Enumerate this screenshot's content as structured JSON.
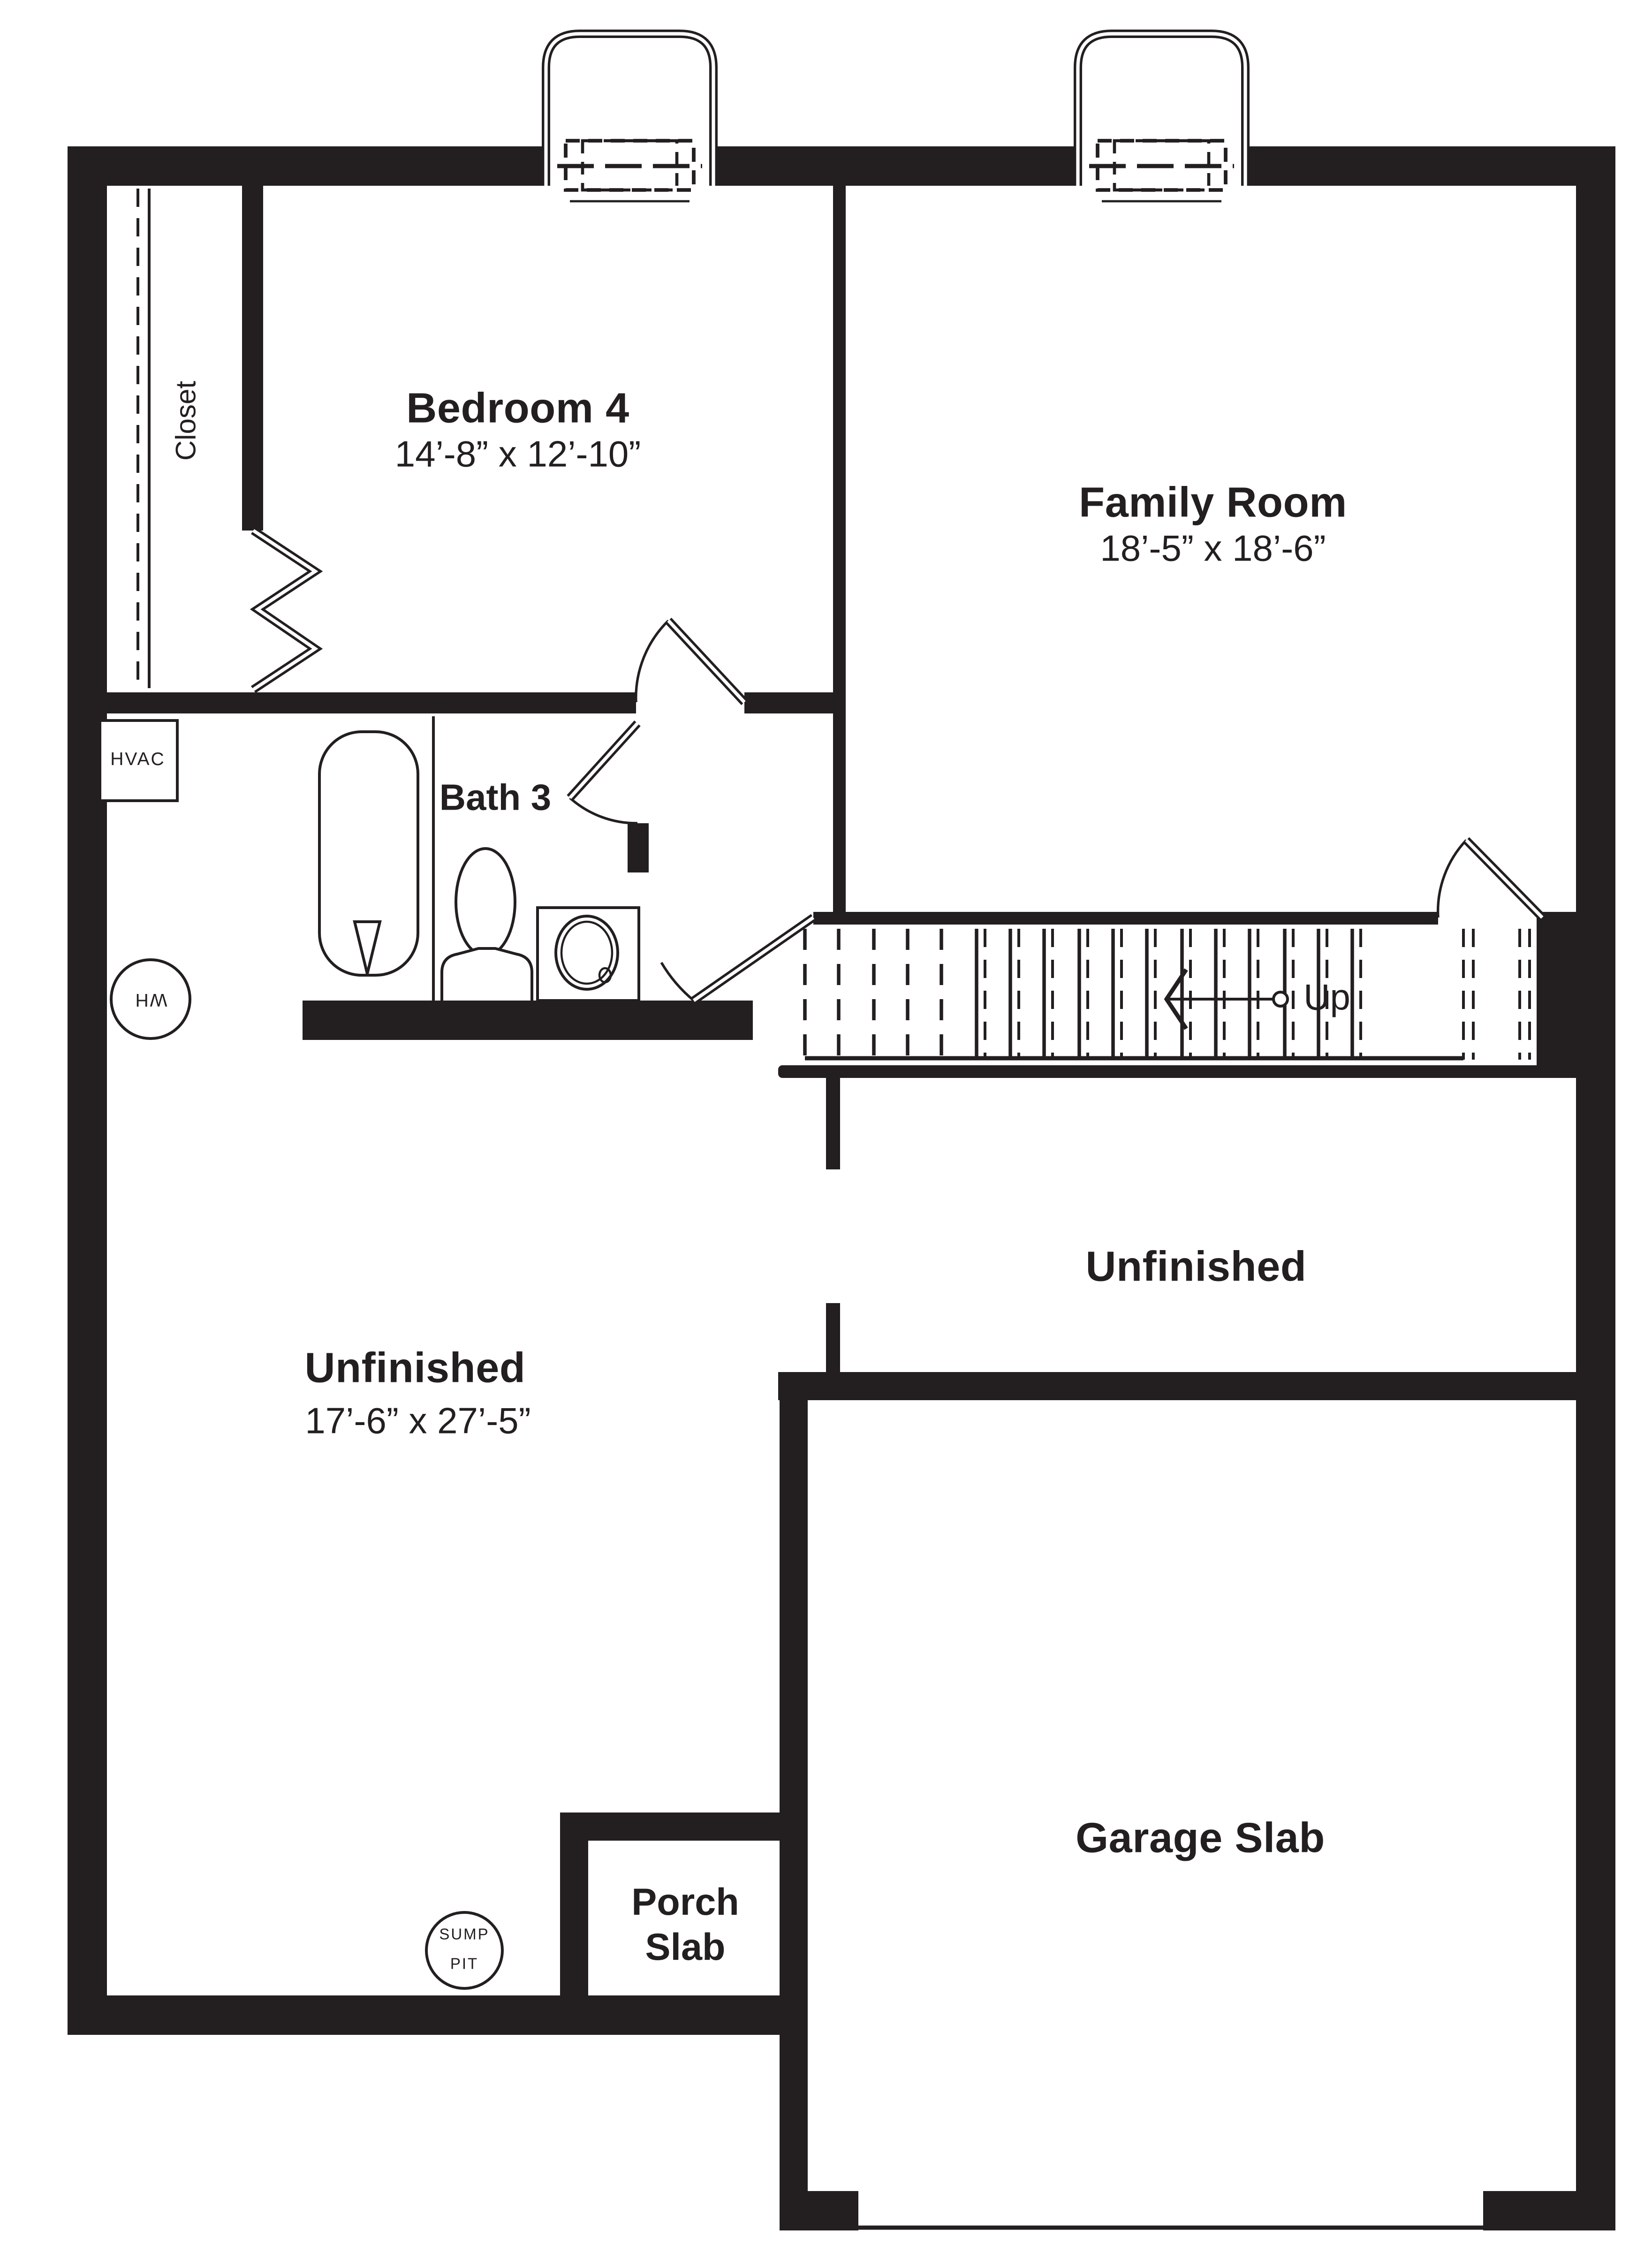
{
  "title": "Basement Floor Plan",
  "colors": {
    "wall": "#231f20",
    "background": "#ffffff"
  },
  "rooms": {
    "bedroom4": {
      "name": "Bedroom 4",
      "dims": "14’-8” x 12’-10”"
    },
    "family_room": {
      "name": "Family Room",
      "dims": "18’-5” x 18’-6”"
    },
    "bath3": {
      "name": "Bath 3"
    },
    "closet": {
      "name": "Closet"
    },
    "unfinished_left": {
      "name": "Unfinished",
      "dims": "17’-6” x 27’-5”"
    },
    "unfinished_right": {
      "name": "Unfinished"
    },
    "garage": {
      "name": "Garage Slab"
    },
    "porch": {
      "name": "Porch\nSlab"
    }
  },
  "fixtures": {
    "hvac": "HVAC",
    "water_heater": "WH",
    "sump_pit": "SUMP\nPIT"
  },
  "stairs": {
    "direction_label": "Up"
  }
}
